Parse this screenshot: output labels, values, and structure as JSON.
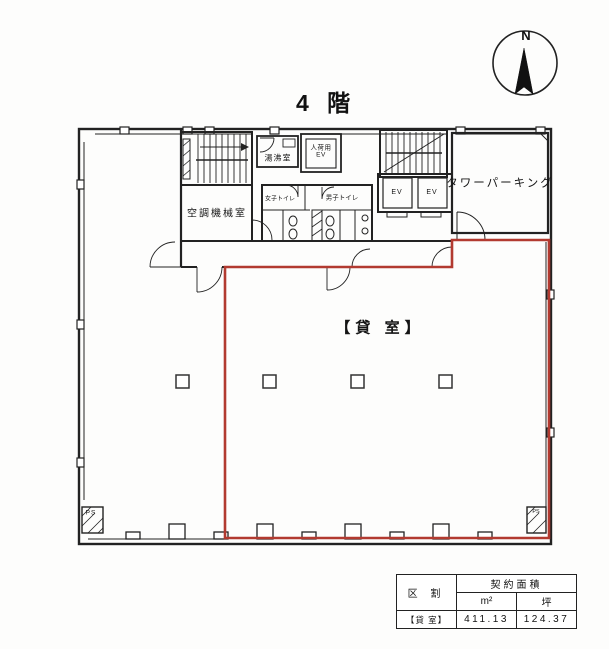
{
  "title": "4 階",
  "compass": {
    "north_label": "N"
  },
  "plan": {
    "rental_label": "【貸 室】",
    "machine_room": "空調機械室",
    "kitchenette": "湯沸室",
    "freight_elevator_line1": "人荷用",
    "freight_elevator_line2": "EV",
    "womens_toilet": "女子トイレ",
    "mens_toilet": "男子トイレ",
    "elevator1": "EV",
    "elevator2": "EV",
    "tower_parking": "タワーパーキング",
    "pipe_shaft_left": "PS",
    "pipe_shaft_right": "PS"
  },
  "area_table": {
    "contract_area_header": "契約面積",
    "division_header": "区 割",
    "unit_m2": "m²",
    "unit_tsubo": "坪",
    "rows": [
      {
        "division": "【貸 室】",
        "m2": "411.13",
        "tsubo": "124.37"
      }
    ]
  },
  "colors": {
    "boundary_red": "#b23a30",
    "line": "#2b2b2b"
  }
}
